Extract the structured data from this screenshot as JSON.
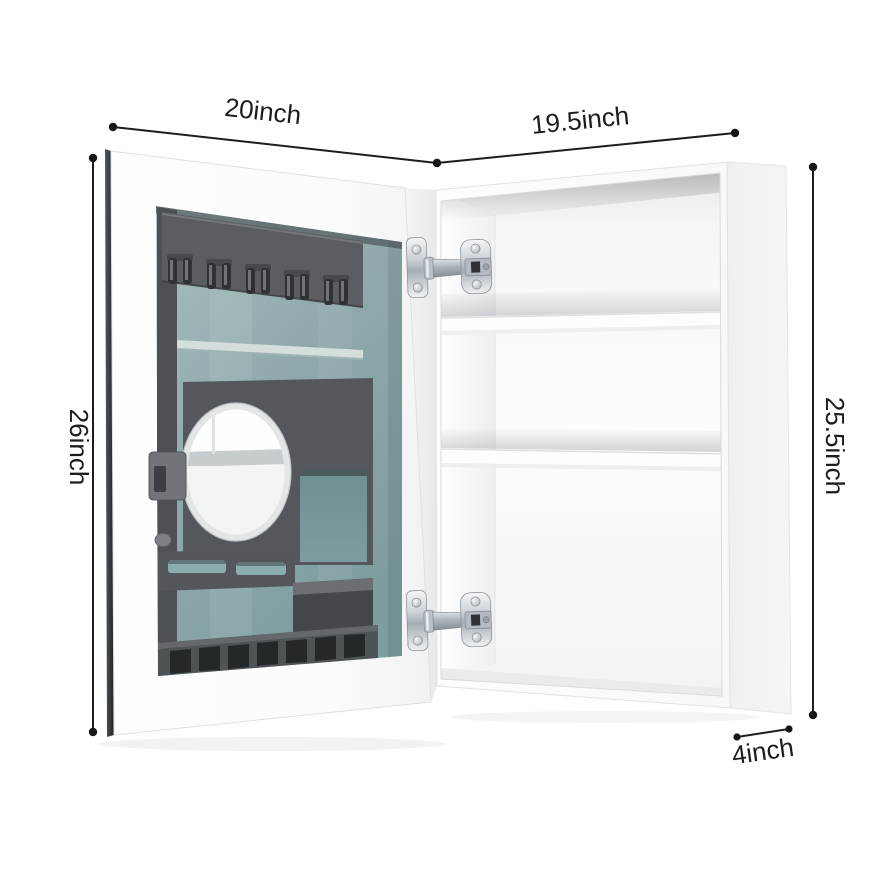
{
  "diagram": {
    "type": "product-dimension-diagram",
    "product": "wall medicine cabinet with open organizer mirror door",
    "background_color": "#ffffff",
    "dimension_line_color": "#1b1d1f",
    "labels": {
      "door_width": "20inch",
      "body_width": "19.5inch",
      "door_height": "26inch",
      "body_height": "25.5inch",
      "body_depth": "4inch"
    },
    "door": {
      "glass_color": "#8fa9ab",
      "organizer_color": "#55595c",
      "hook_count": 5,
      "strap_slot_count": 2,
      "toothbrush_slot_count": 7,
      "mirror": "oval-mirror"
    },
    "body": {
      "color": "#ffffff",
      "shelf_count": 2,
      "hinge_count": 2,
      "hinge_color": "#c3cad0"
    }
  }
}
